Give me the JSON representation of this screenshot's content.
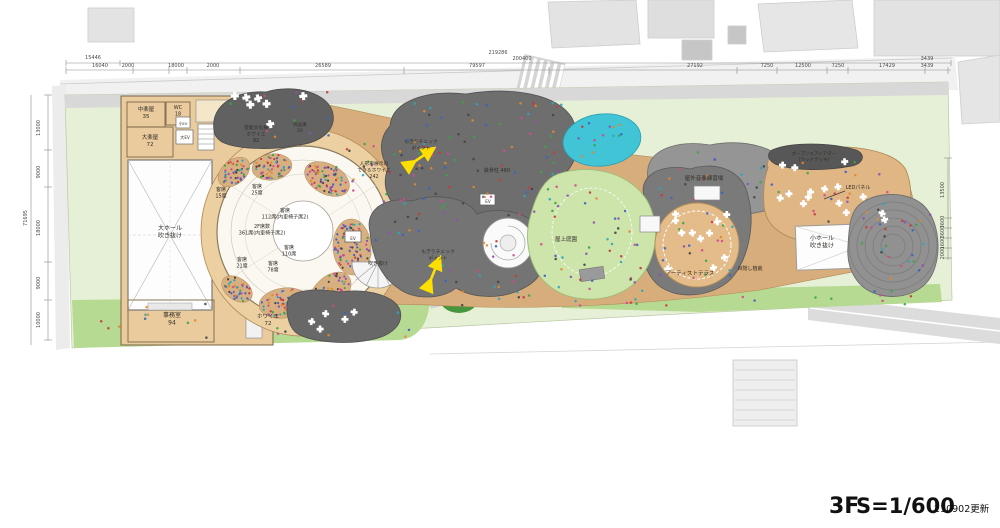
{
  "title_block": {
    "floor": "3F",
    "scale": "S=1/600",
    "updated": "210902更新"
  },
  "dimensions": {
    "top": [
      {
        "t": "15446",
        "x": 93,
        "y": 59
      },
      {
        "t": "219286",
        "x": 498,
        "y": 54
      },
      {
        "t": "200400",
        "x": 522,
        "y": 60
      },
      {
        "t": "16040",
        "x": 100,
        "y": 67
      },
      {
        "t": "2000",
        "x": 128,
        "y": 67
      },
      {
        "t": "18000",
        "x": 176,
        "y": 67
      },
      {
        "t": "2000",
        "x": 213,
        "y": 67
      },
      {
        "t": "26589",
        "x": 323,
        "y": 67
      },
      {
        "t": "79597",
        "x": 477,
        "y": 67
      },
      {
        "t": "27192",
        "x": 695,
        "y": 67
      },
      {
        "t": "7250",
        "x": 767,
        "y": 67
      },
      {
        "t": "12500",
        "x": 803,
        "y": 67
      },
      {
        "t": "7250",
        "x": 838,
        "y": 67
      },
      {
        "t": "17429",
        "x": 887,
        "y": 67
      },
      {
        "t": "3439",
        "x": 927,
        "y": 60
      },
      {
        "t": "3439",
        "x": 927,
        "y": 67
      }
    ],
    "left_overall": {
      "t": "71695",
      "x": 27,
      "y": 218
    },
    "left_segments": [
      {
        "t": "13000",
        "y": 128
      },
      {
        "t": "9000",
        "y": 172
      },
      {
        "t": "18000",
        "y": 228
      },
      {
        "t": "9000",
        "y": 283
      },
      {
        "t": "10000",
        "y": 320
      }
    ],
    "right_segments": [
      {
        "t": "13500",
        "y": 190
      },
      {
        "t": "3600",
        "y": 222
      },
      {
        "t": "3600",
        "y": 232
      },
      {
        "t": "1600",
        "y": 243
      },
      {
        "t": "2000",
        "y": 253
      }
    ]
  },
  "plan_labels": [
    {
      "id": "naka-gakuya",
      "x": 146,
      "y": 111,
      "size": 5.5,
      "lines": [
        "中楽屋",
        "35"
      ]
    },
    {
      "id": "wc",
      "x": 178,
      "y": 109,
      "size": 5,
      "lines": [
        "WC",
        "18"
      ]
    },
    {
      "id": "oo-gakuya",
      "x": 150,
      "y": 139,
      "size": 5.5,
      "lines": [
        "大楽屋",
        "72"
      ]
    },
    {
      "id": "ko-ev",
      "x": 183,
      "y": 125,
      "size": 3.8,
      "lines": [
        "小EV"
      ]
    },
    {
      "id": "dai-ev",
      "x": 185,
      "y": 139,
      "size": 4.2,
      "lines": [
        "大EV"
      ]
    },
    {
      "id": "main-hall-void",
      "x": 170,
      "y": 230,
      "size": 6,
      "lines": [
        "大ホール",
        "吹き抜け"
      ]
    },
    {
      "id": "office",
      "x": 172,
      "y": 317,
      "size": 6,
      "lines": [
        "事務室",
        "94"
      ]
    },
    {
      "id": "geino-foyer",
      "x": 256,
      "y": 129,
      "size": 4.8,
      "lines": [
        "芸能文化棟",
        "ホワイエ",
        "82"
      ]
    },
    {
      "id": "shohinko",
      "x": 300,
      "y": 126,
      "size": 4.5,
      "lines": [
        "商品庫",
        "20"
      ]
    },
    {
      "id": "seat-15",
      "x": 221,
      "y": 191,
      "size": 5,
      "lines": [
        "客席",
        "15席"
      ]
    },
    {
      "id": "seat-25",
      "x": 257,
      "y": 188,
      "size": 5,
      "lines": [
        "客席",
        "25席"
      ]
    },
    {
      "id": "seat-112",
      "x": 285,
      "y": 212,
      "size": 5,
      "lines": [
        "客席",
        "112席(内車椅子席2)"
      ]
    },
    {
      "id": "f2-seats",
      "x": 262,
      "y": 228,
      "size": 5,
      "lines": [
        "2F席数",
        "361席(内車椅子席2)"
      ]
    },
    {
      "id": "seat-110",
      "x": 289,
      "y": 249,
      "size": 5,
      "lines": [
        "客席",
        "110席"
      ]
    },
    {
      "id": "seat-21",
      "x": 242,
      "y": 261,
      "size": 5,
      "lines": [
        "客席",
        "21席"
      ]
    },
    {
      "id": "seat-78",
      "x": 273,
      "y": 265,
      "size": 5,
      "lines": [
        "客席",
        "78席"
      ]
    },
    {
      "id": "foyer-72",
      "x": 268,
      "y": 318,
      "size": 5.5,
      "lines": [
        "ホワイエ",
        "72"
      ]
    },
    {
      "id": "ningyo-foyer",
      "x": 374,
      "y": 165,
      "size": 4.8,
      "lines": [
        "人形車展示の",
        "できるホワイエ",
        "242"
      ]
    },
    {
      "id": "mogiri-checkpoint-1",
      "x": 421,
      "y": 143,
      "size": 4.8,
      "lines": [
        "もぎりチェック",
        "ポイント"
      ]
    },
    {
      "id": "tekkotsu-chu",
      "x": 497,
      "y": 172,
      "size": 5,
      "lines": [
        "鉄骨柱 460"
      ]
    },
    {
      "id": "ev-1",
      "x": 488,
      "y": 203,
      "size": 4.2,
      "lines": [
        "EV"
      ]
    },
    {
      "id": "ev-2",
      "x": 353,
      "y": 240,
      "size": 4.2,
      "lines": [
        "EV"
      ]
    },
    {
      "id": "fukinuke-stair",
      "x": 378,
      "y": 265,
      "size": 5,
      "lines": [
        "吹き抜け"
      ]
    },
    {
      "id": "mogiri-checkpoint-2",
      "x": 438,
      "y": 253,
      "size": 4.8,
      "lines": [
        "もぎりチェック",
        "ポイント"
      ]
    },
    {
      "id": "okujo-teien",
      "x": 566,
      "y": 241,
      "size": 5.5,
      "lines": [
        "屋上庭園"
      ]
    },
    {
      "id": "okugai-ongaku",
      "x": 704,
      "y": 180,
      "size": 5.5,
      "lines": [
        "屋外音楽練習場"
      ]
    },
    {
      "id": "artist-terrace",
      "x": 690,
      "y": 275,
      "size": 5.5,
      "lines": [
        "アーティストテラス"
      ]
    },
    {
      "id": "mekakushi-shokusai",
      "x": 750,
      "y": 270,
      "size": 5,
      "lines": [
        "目隠し植栽"
      ]
    },
    {
      "id": "led-panel",
      "x": 858,
      "y": 189,
      "size": 5,
      "lines": [
        "LEDパネル"
      ]
    },
    {
      "id": "open-air-theater",
      "x": 814,
      "y": 155,
      "size": 4.5,
      "color": "#e8e2d2",
      "lines": [
        "オープンエアシアター",
        "(ウッドデッキ)"
      ]
    },
    {
      "id": "ko-hall-void",
      "x": 822,
      "y": 240,
      "size": 6,
      "lines": [
        "小ホール",
        "吹き抜け"
      ]
    }
  ],
  "colors": {
    "wood_deck": "#d8ad7c",
    "foyer_ring": "#ecd0a2",
    "roof_dark": "#6a6a6a",
    "roof_mid": "#787878",
    "roof_light": "#919191",
    "garden_green": "#cde4ab",
    "lawn": "#b7da92",
    "site_green": "#e6f0d6",
    "pool_cyan": "#41c4d6",
    "arrow_yellow": "#ffdf00",
    "neighbor_gray": "#e3e3e3"
  }
}
